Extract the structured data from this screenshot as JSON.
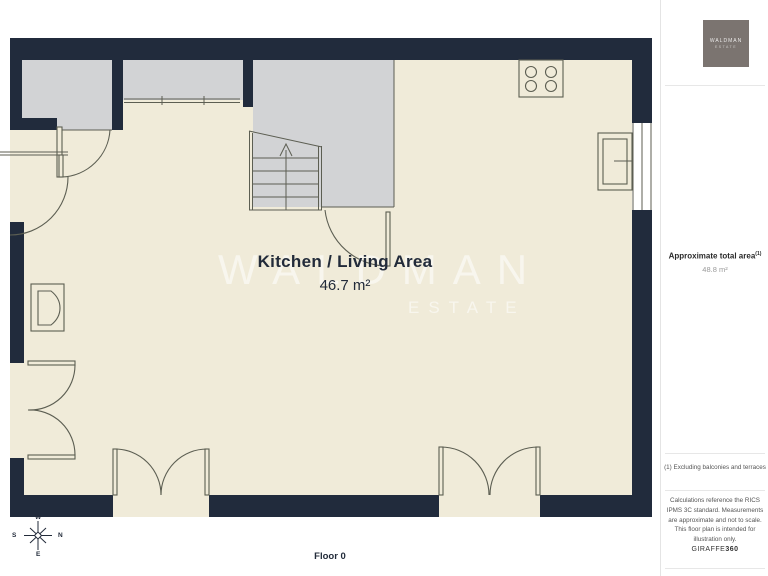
{
  "plan": {
    "room": {
      "name": "Kitchen / Living Area",
      "area": "46.7 m²"
    },
    "floor_label": "Floor 0",
    "watermark": {
      "line1": "WALDMAN",
      "line2": "ESTATE"
    },
    "compass": {
      "top": "W",
      "right": "N",
      "bottom": "E",
      "left": "S"
    },
    "fixtures": [
      "staircase",
      "stove-hob",
      "fridge",
      "armchair",
      "double-doors",
      "windows"
    ]
  },
  "sidebar": {
    "logo": {
      "line1": "WALDMAN",
      "line2": "ESTATE"
    },
    "total_area": {
      "label": "Approximate total area",
      "superscript": "(1)",
      "value": "48.8 m²"
    },
    "footnote": "(1) Excluding balconies and terraces",
    "disclaimer": "Calculations reference the RICS IPMS 3C standard. Measurements are approximate and not to scale. This floor plan is intended for illustration only.",
    "brand": {
      "name": "GIRAFFE",
      "suffix": "360"
    }
  },
  "colors": {
    "wall": "#212b3c",
    "floor": "#f0ebd9",
    "outside": "#d2d3d5",
    "stroke": "#5c5e52",
    "sidebar_logo_bg": "#7b7470",
    "text": "#222b3a"
  }
}
